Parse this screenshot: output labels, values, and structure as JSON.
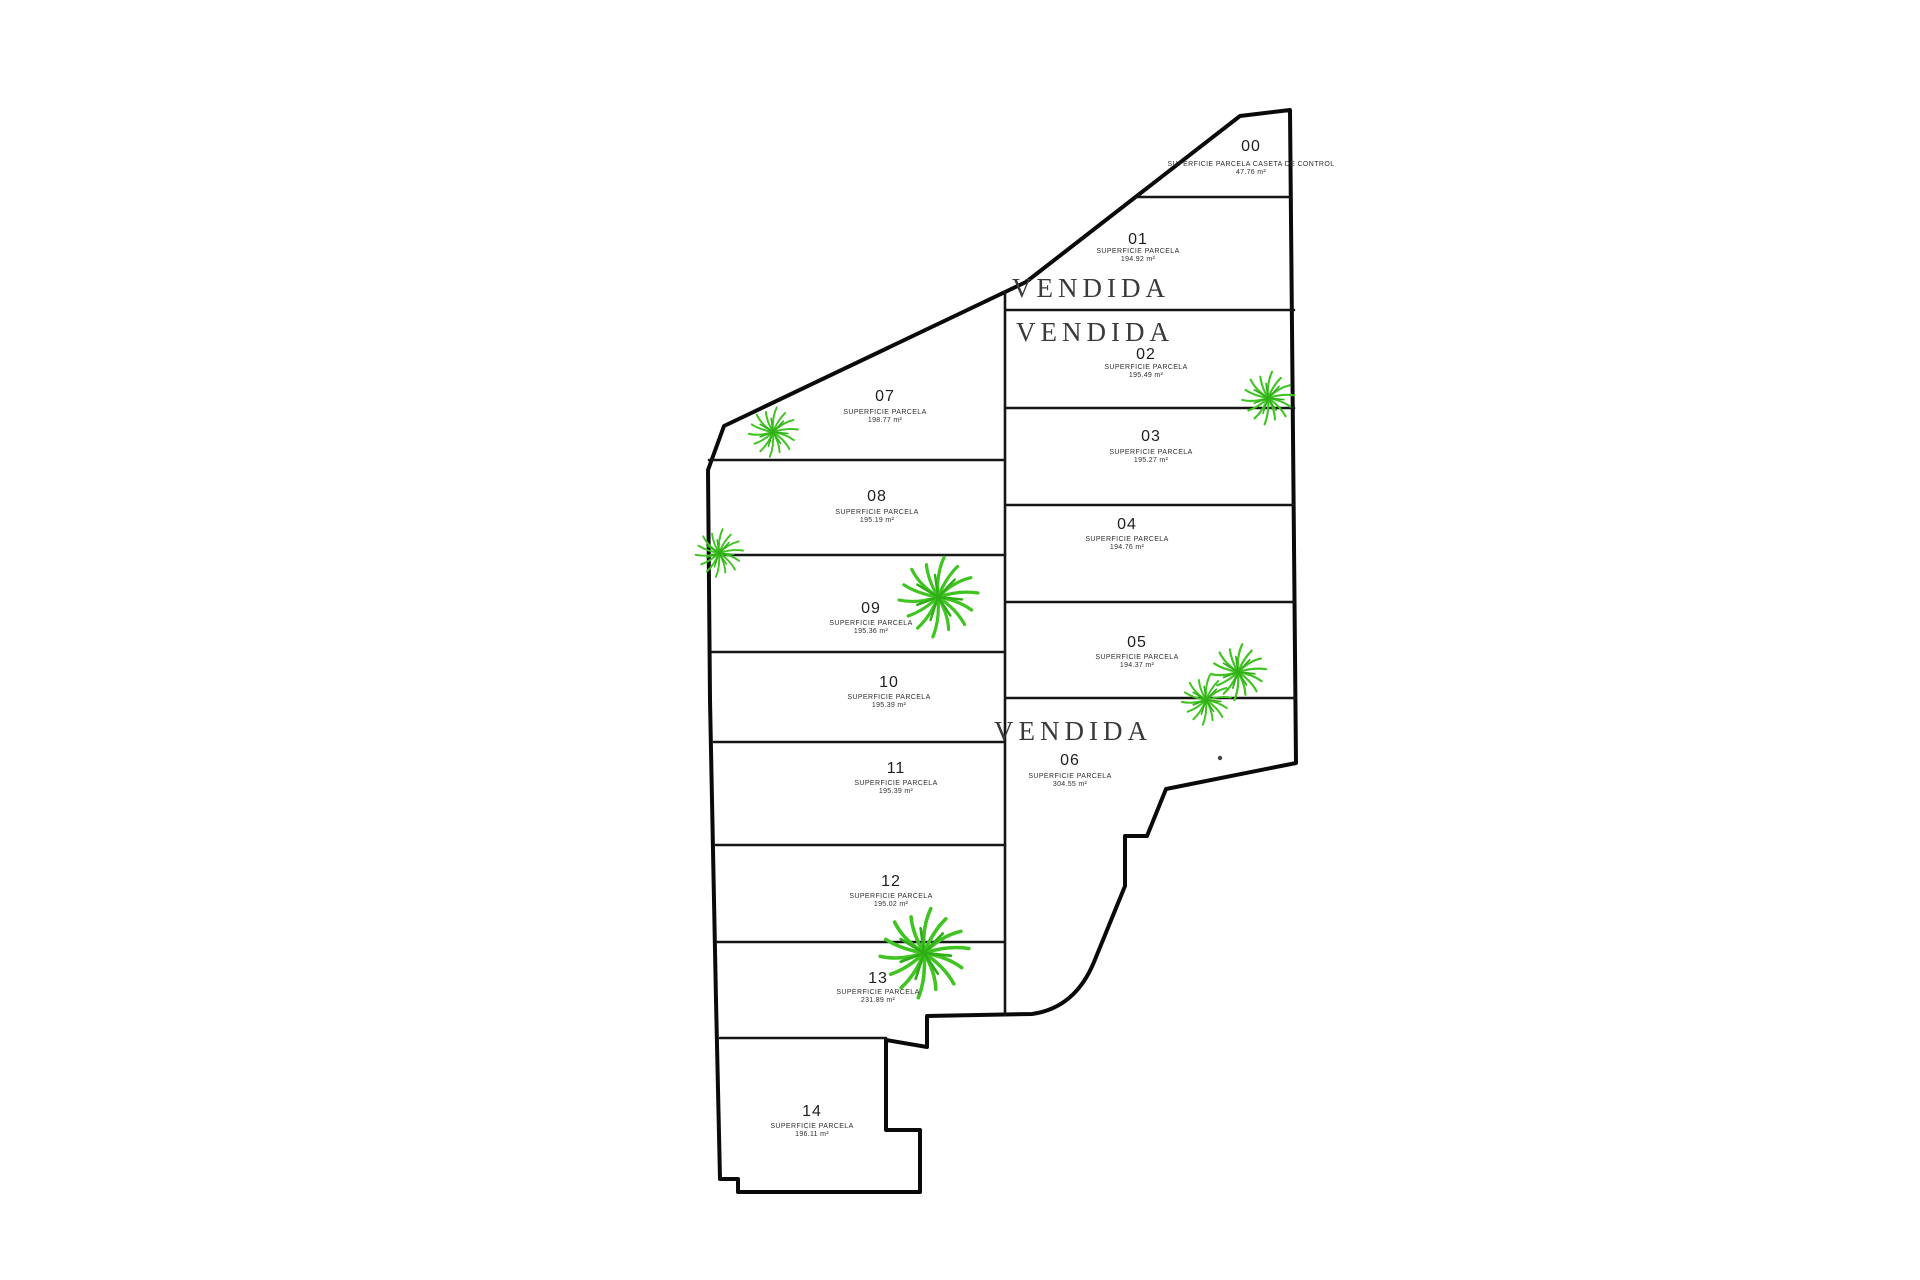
{
  "plan": {
    "sold_label": "VENDIDA",
    "colors": {
      "outline": "#0a0a0a",
      "boundary": "#161616",
      "plant": "#3fc421"
    },
    "parcels": [
      {
        "id": "00",
        "label": "SUPERFICIE PARCELA CASETA DE CONTROL",
        "area": "47.76 m²",
        "sold": false
      },
      {
        "id": "01",
        "label": "SUPERFICIE PARCELA",
        "area": "194.92 m²",
        "sold": true
      },
      {
        "id": "02",
        "label": "SUPERFICIE PARCELA",
        "area": "195.49 m²",
        "sold": true
      },
      {
        "id": "03",
        "label": "SUPERFICIE PARCELA",
        "area": "195.27 m²",
        "sold": false
      },
      {
        "id": "04",
        "label": "SUPERFICIE PARCELA",
        "area": "194.76 m²",
        "sold": false
      },
      {
        "id": "05",
        "label": "SUPERFICIE PARCELA",
        "area": "194.37 m²",
        "sold": false
      },
      {
        "id": "06",
        "label": "SUPERFICIE PARCELA",
        "area": "304.55 m²",
        "sold": true
      },
      {
        "id": "07",
        "label": "SUPERFICIE PARCELA",
        "area": "198.77 m²",
        "sold": false
      },
      {
        "id": "08",
        "label": "SUPERFICIE PARCELA",
        "area": "195.19 m²",
        "sold": false
      },
      {
        "id": "09",
        "label": "SUPERFICIE PARCELA",
        "area": "195.36 m²",
        "sold": false
      },
      {
        "id": "10",
        "label": "SUPERFICIE PARCELA",
        "area": "195.39 m²",
        "sold": false
      },
      {
        "id": "11",
        "label": "SUPERFICIE PARCELA",
        "area": "195.39 m²",
        "sold": false
      },
      {
        "id": "12",
        "label": "SUPERFICIE PARCELA",
        "area": "195.02 m²",
        "sold": false
      },
      {
        "id": "13",
        "label": "SUPERFICIE PARCELA",
        "area": "231.89 m²",
        "sold": false
      },
      {
        "id": "14",
        "label": "SUPERFICIE PARCELA",
        "area": "196.11 m²",
        "sold": false
      }
    ]
  }
}
